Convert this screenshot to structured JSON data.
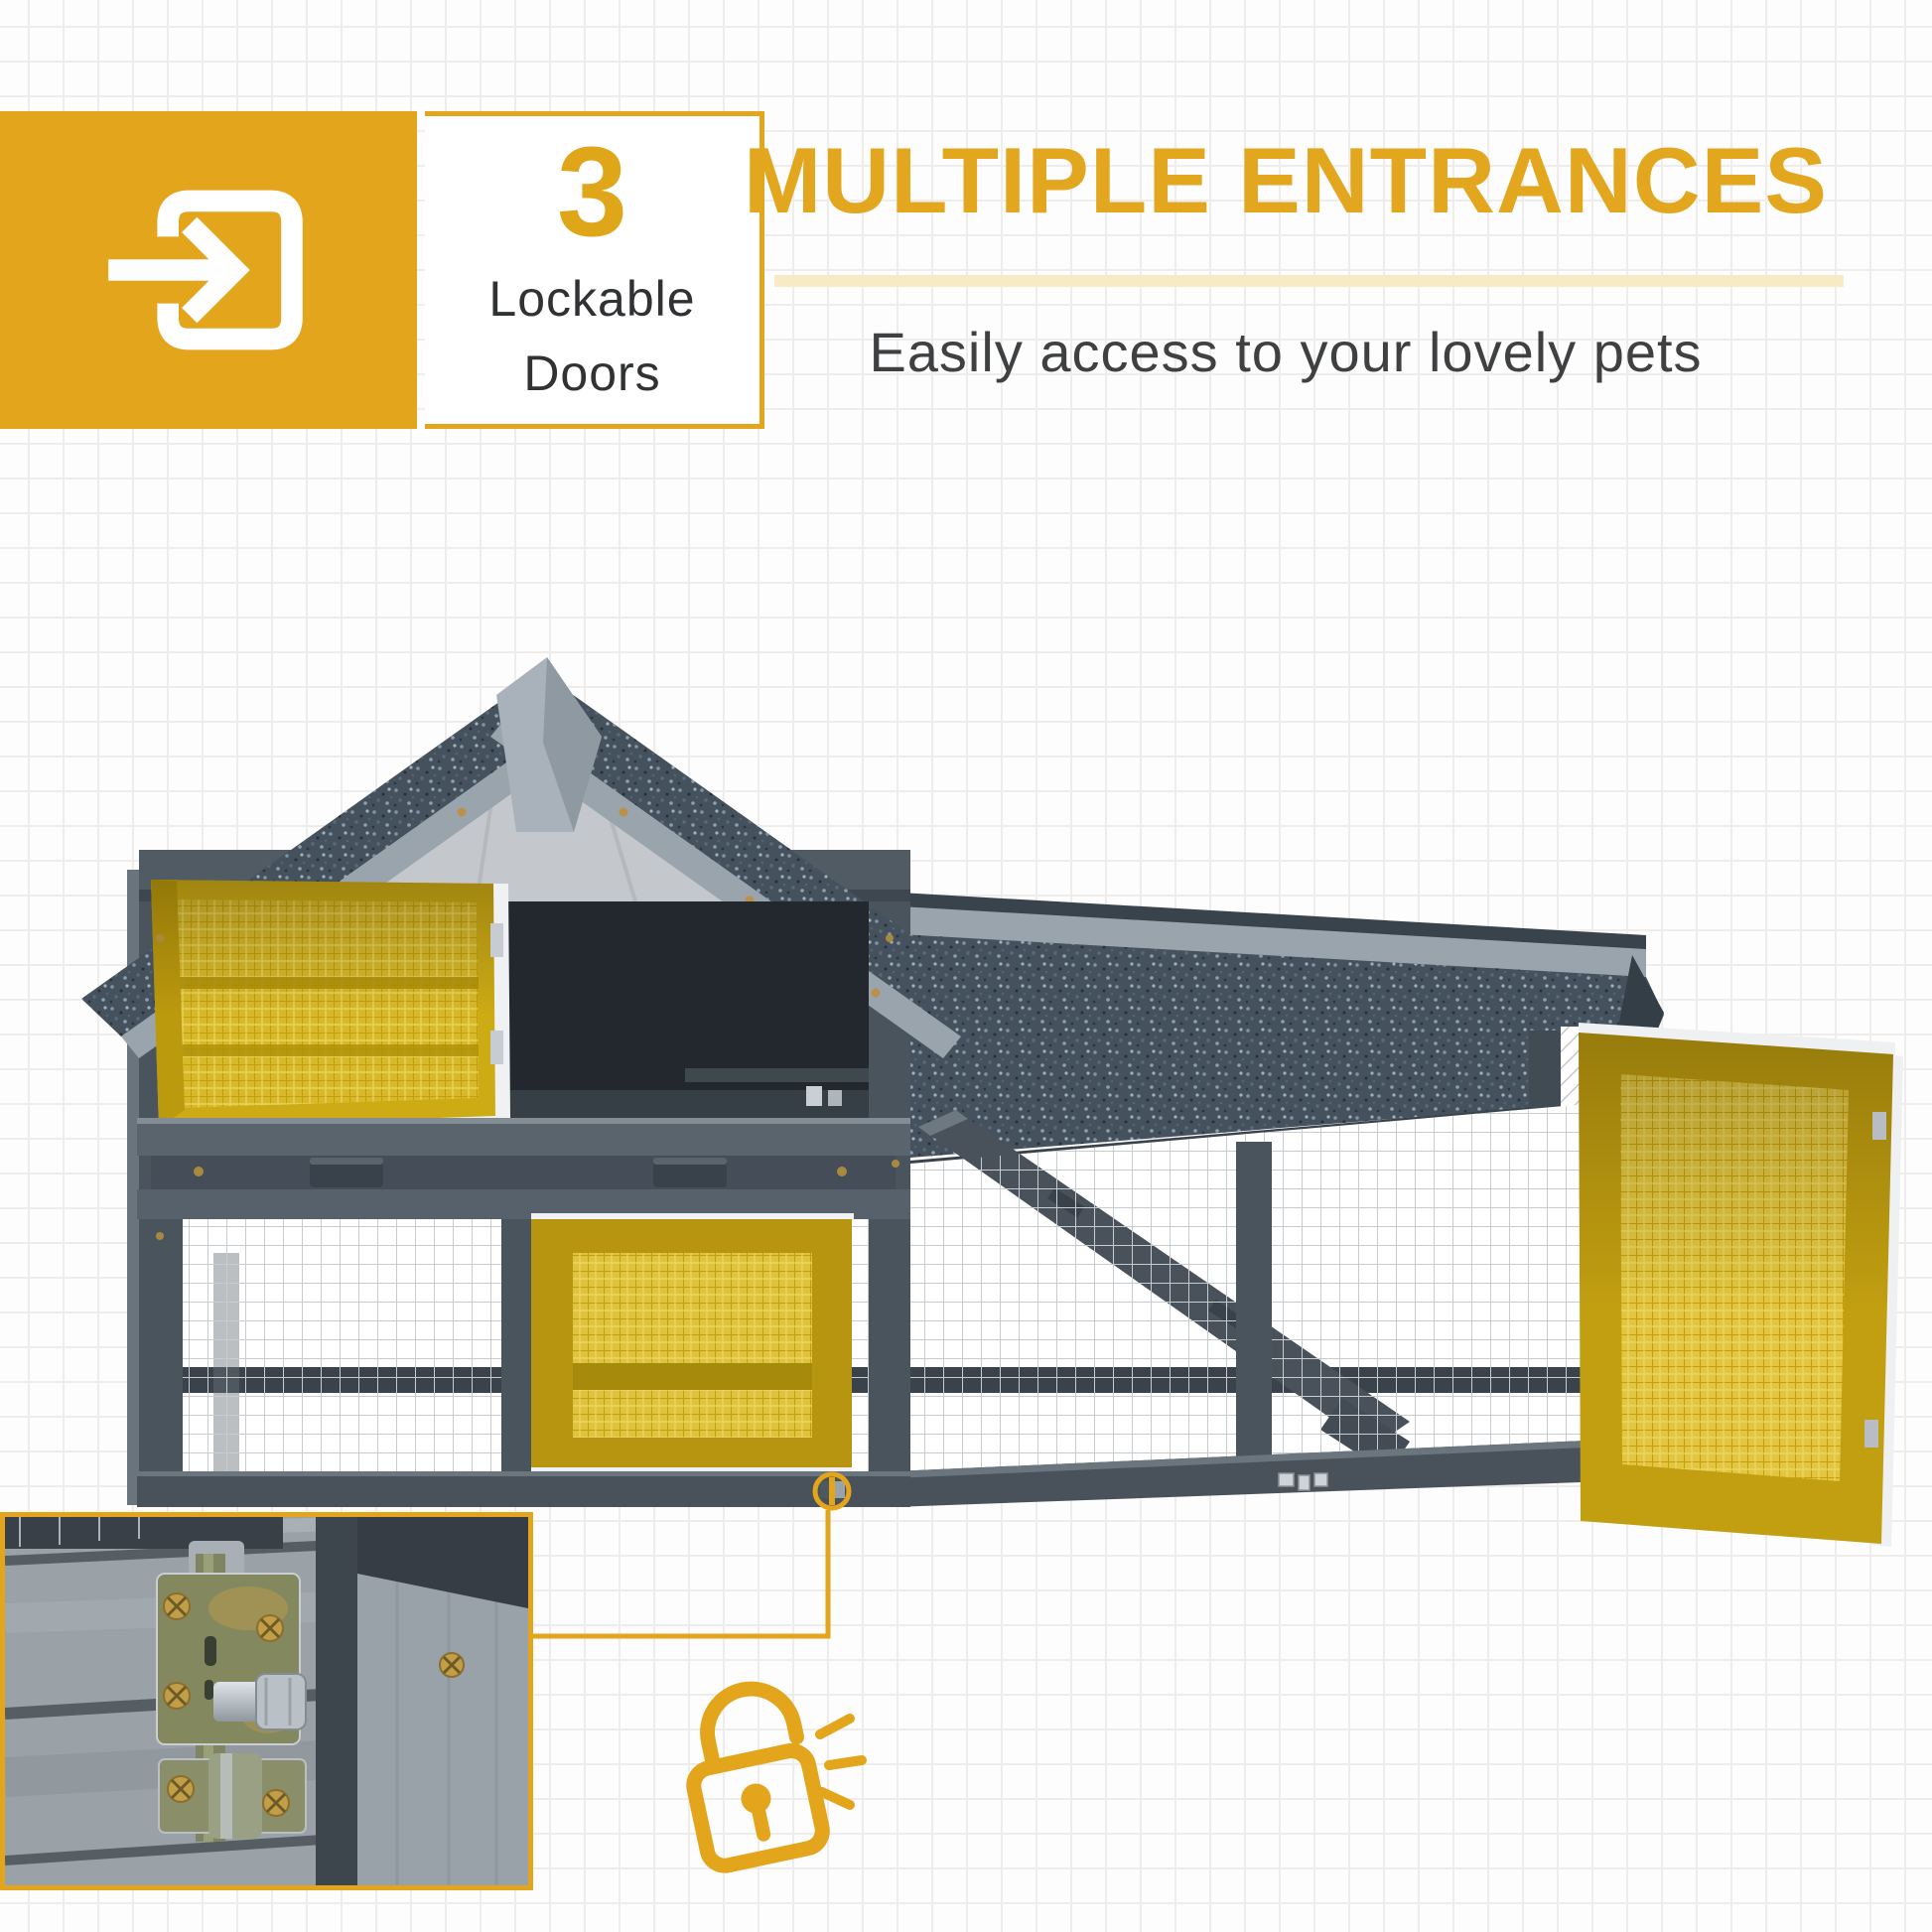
{
  "badge": {
    "icon": "enter-door-arrow-icon",
    "count": "3",
    "label_line1": "Lockable",
    "label_line2": "Doors"
  },
  "header": {
    "title": "MULTIPLE ENTRANCES",
    "subtitle": "Easily access to your lovely pets"
  },
  "figure": {
    "type": "product-photo",
    "subject": "two-story grey wooden pet hutch with asphalt roof, wire mesh run and three yellow-highlighted lockable doors",
    "highlighted_doors": [
      "upper-hutch-door",
      "lower-run-door",
      "side-run-door-open"
    ],
    "callouts": [
      "latch-highlight-circle",
      "lock-closeup-inset",
      "open-padlock-icon"
    ]
  },
  "colors": {
    "accent_yellow": "#E2A51B",
    "number_yellow": "#DFA61A",
    "underline_cream": "#F6EBC5",
    "text_dark": "#303234",
    "subtitle_gray": "#3E4042",
    "roof_slate": "#45525D",
    "frame_gray": "#4A545D",
    "door_highlight": "#CDAB15"
  }
}
